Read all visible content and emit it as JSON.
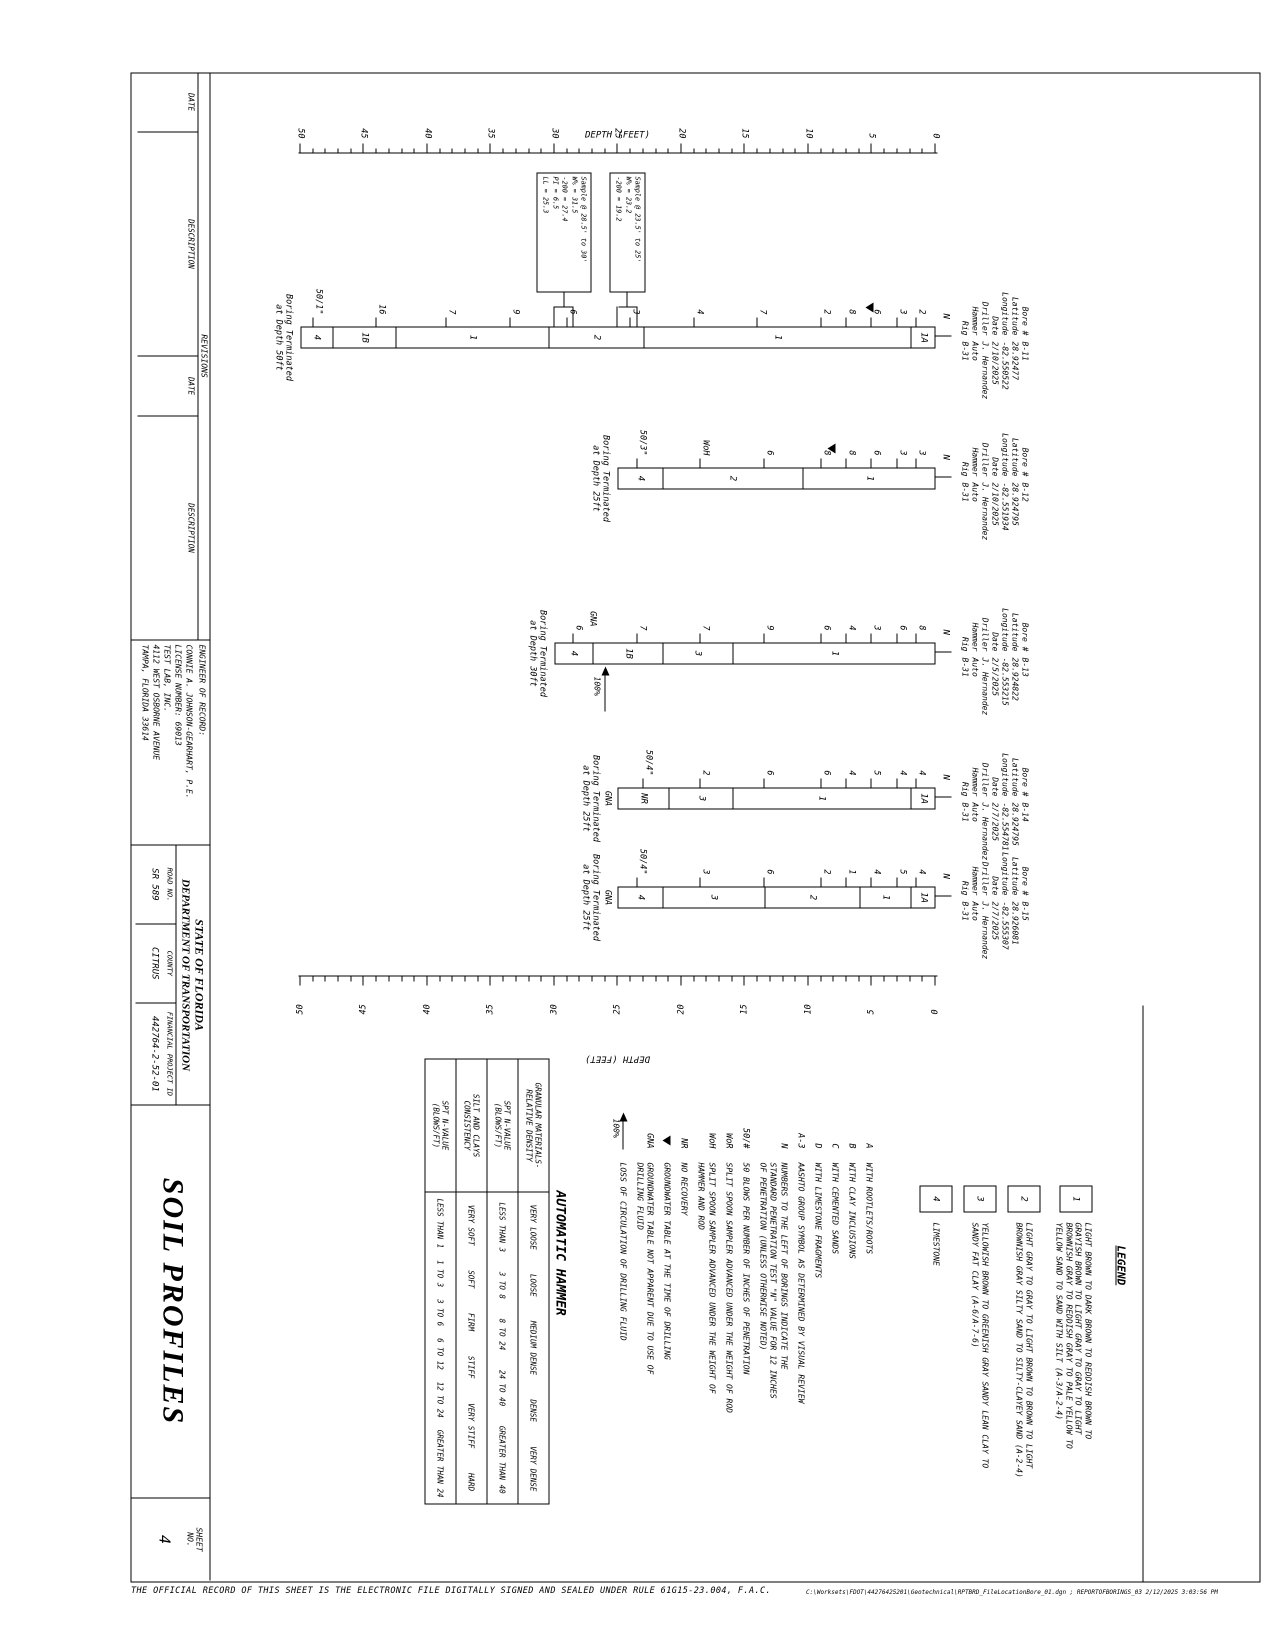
{
  "page": {
    "disclaimer": "THE OFFICIAL RECORD OF THIS SHEET IS THE ELECTRONIC FILE DIGITALLY SIGNED AND SEALED UNDER RULE 61G15-23.004, F.A.C.",
    "plot_stamp": "C:\\Worksets\\FDOT\\44276425201\\Geotechnical\\RPTBRD_FileLocationBore_01.dgn ; REPORTOFBORINGS_03    2/12/2025 3:03:56 PM"
  },
  "title_block": {
    "revisions_label": "REVISIONS",
    "rev_col_headers": [
      "DATE",
      "DESCRIPTION",
      "DATE",
      "DESCRIPTION"
    ],
    "engineer_label": "ENGINEER OF RECORD:",
    "engineer_text": "CONNIE A. JOHNSON-GEARHART, P.E.\nLICENSE NUMBER: 69013\nTEST LAB, INC.\n4112 WEST OSBORNE AVENUE\nTAMPA, FLORIDA 33614",
    "agency_line1": "STATE OF FLORIDA",
    "agency_line2": "DEPARTMENT OF TRANSPORTATION",
    "road_no_label": "ROAD NO.",
    "road_no": "SR 589",
    "county_label": "COUNTY",
    "county": "CITRUS",
    "fpid_label": "FINANCIAL PROJECT ID",
    "fpid": "442764-2-52-01",
    "sheet_title": "SOIL PROFILES",
    "sheet_no_label": "SHEET\nNO.",
    "sheet_no": "4"
  },
  "axis": {
    "caption": "DEPTH (FEET)",
    "min": 0,
    "max": 50,
    "major_step": 5
  },
  "legend": {
    "title": "LEGEND",
    "items": [
      {
        "symbol": "1",
        "text": "LIGHT BROWN TO DARK BROWN TO REDDISH BROWN TO\nGRAYISH BROWN TO LIGHT GRAY TO GRAY TO LIGHT\nBROWNISH GRAY TO REDDISH GRAY TO PALE YELLOW TO\nYELLOW SAND TO SAND WITH SILT (A-3/A-2-4)"
      },
      {
        "symbol": "2",
        "text": "LIGHT GRAY TO GRAY TO LIGHT BROWN TO BROWN TO LIGHT\nBROWNISH GRAY SILTY SAND TO SILTY-CLAYEY SAND (A-2-4)"
      },
      {
        "symbol": "3",
        "text": "YELLOWISH BROWN TO GREENISH GRAY SANDY LEAN CLAY TO\nSANDY FAT CLAY (A-6/A-7-6)"
      },
      {
        "symbol": "4",
        "text": "LIMESTONE"
      }
    ]
  },
  "notes": [
    {
      "symbol": "A",
      "type": "text",
      "text": "WITH ROOTLETS/ROOTS"
    },
    {
      "symbol": "B",
      "type": "text",
      "text": "WITH CLAY INCLUSIONS"
    },
    {
      "symbol": "C",
      "type": "text",
      "text": "WITH CEMENTED SANDS"
    },
    {
      "symbol": "D",
      "type": "text",
      "text": "WITH LIMESTONE FRAGMENTS"
    },
    {
      "symbol": "A-3",
      "type": "text",
      "text": "AASHTO GROUP SYMBOL AS DETERMINED BY VISUAL REVIEW"
    },
    {
      "symbol": "N",
      "type": "text",
      "text": "NUMBERS TO THE LEFT OF BORINGS INDICATE THE\nSTANDARD PENETRATION TEST \"N\" VALUE FOR 12 INCHES\nOF PENETRATION (UNLESS OTHERWISE NOTED)"
    },
    {
      "symbol": "50/#",
      "type": "text",
      "text": "50 BLOWS PER NUMBER OF INCHES OF PENETRATION"
    },
    {
      "symbol": "WoR",
      "type": "text",
      "text": "SPLIT SPOON SAMPLER ADVANCED UNDER THE WEIGHT OF ROD"
    },
    {
      "symbol": "WoH",
      "type": "text",
      "text": "SPLIT SPOON SAMPLER ADVANCED UNDER THE WEIGHT OF\nHAMMER AND ROD"
    },
    {
      "symbol": "NR",
      "type": "text",
      "text": "NO RECOVERY"
    },
    {
      "symbol": "gw",
      "type": "gw",
      "text": "GROUNDWATER TABLE AT THE TIME OF DRILLING"
    },
    {
      "symbol": "GNA",
      "type": "text",
      "text": "GROUNDWATER TABLE NOT APPARENT DUE TO USE OF\nDRILLING FLUID"
    },
    {
      "symbol": "100%",
      "type": "loss",
      "text": "LOSS OF CIRCULATION OF DRILLING FLUID"
    }
  ],
  "hammer_table": {
    "title": "AUTOMATIC HAMMER",
    "rows": [
      {
        "label": "GRANULAR MATERIALS-\nRELATIVE DENSITY",
        "values": [
          "VERY LOOSE",
          "LOOSE",
          "MEDIUM DENSE",
          "DENSE",
          "VERY DENSE"
        ]
      },
      {
        "label": "SPT N-VALUE\n(BLOWS/FT)",
        "values": [
          "LESS THAN 3",
          "3 TO 8",
          "8 TO 24",
          "24 TO 40",
          "GREATER THAN 40"
        ]
      },
      {
        "label": "SILT AND CLAYS\nCONSISTENCY",
        "values": [
          "VERY SOFT",
          "SOFT",
          "FIRM",
          "STIFF",
          "VERY STIFF",
          "HARD"
        ]
      },
      {
        "label": "SPT N-VALUE\n(BLOWS/FT)",
        "values": [
          "LESS THAN 1",
          "1 TO 3",
          "3 TO 6",
          "6 TO 12",
          "12 TO 24",
          "GREATER THAN 24"
        ]
      }
    ]
  },
  "borings": [
    {
      "id": "B-11",
      "x_center": 337,
      "n_column_label": "N",
      "header_labels": [
        "Bore #",
        "Latitude",
        "Longitude",
        "Date",
        "Driller",
        "Hammer",
        "Rig"
      ],
      "header_values": [
        "B-11",
        "28.92477",
        "-82.550522",
        "2/10/2025",
        "J. Hernandez",
        "Auto",
        "B-31"
      ],
      "termination_depth": 50,
      "termination_text": "Boring Terminated\nat Depth 50ft",
      "groundwater_depth": 5.5,
      "n_values": [
        {
          "depth": 1.5,
          "label": "2"
        },
        {
          "depth": 3,
          "label": "3"
        },
        {
          "depth": 5,
          "label": "6"
        },
        {
          "depth": 7,
          "label": "8"
        },
        {
          "depth": 9,
          "label": "2"
        },
        {
          "depth": 14,
          "label": "7"
        },
        {
          "depth": 19,
          "label": "4"
        },
        {
          "depth": 24,
          "label": "3"
        },
        {
          "depth": 29,
          "label": "6"
        },
        {
          "depth": 33.5,
          "label": "9"
        },
        {
          "depth": 38.5,
          "label": "7"
        },
        {
          "depth": 44,
          "label": "16"
        },
        {
          "depth": 49,
          "label": "50/1\""
        }
      ],
      "segments": [
        {
          "label": "1A",
          "from": 0,
          "to": 2
        },
        {
          "label": "1",
          "from": 2,
          "to": 23
        },
        {
          "label": "2",
          "from": 23,
          "to": 30.5
        },
        {
          "label": "1",
          "from": 30.5,
          "to": 42.5
        },
        {
          "label": "1B",
          "from": 42.5,
          "to": 47.5
        },
        {
          "label": "4",
          "from": 47.5,
          "to": 50
        }
      ],
      "samples": [
        {
          "from": 23.5,
          "to": 25,
          "text": "Sample @ 23.5' to 25'\nW% = 23.2\n-200 = 19.2"
        },
        {
          "from": 28.5,
          "to": 30,
          "text": "Sample @ 28.5' to 30'\nW% = 31.5\n-200 = 27.4\nPI = 6.5\nLL = 25.3"
        }
      ]
    },
    {
      "id": "B-12",
      "x_center": 478,
      "n_column_label": "N",
      "header_labels": [
        "Bore #",
        "Latitude",
        "Longitude",
        "Date",
        "Driller",
        "Hammer",
        "Rig"
      ],
      "header_values": [
        "B-12",
        "28.924795",
        "-82.551934",
        "2/10/2025",
        "J. Hernandez",
        "Auto",
        "B-31"
      ],
      "termination_depth": 25,
      "termination_text": "Boring Terminated\nat Depth 25ft",
      "groundwater_depth": 8.5,
      "n_values": [
        {
          "depth": 1.5,
          "label": "3"
        },
        {
          "depth": 3,
          "label": "3"
        },
        {
          "depth": 5,
          "label": "6"
        },
        {
          "depth": 7,
          "label": "8"
        },
        {
          "depth": 9,
          "label": "8"
        },
        {
          "depth": 13.5,
          "label": "6"
        },
        {
          "depth": 18.5,
          "label": "WoH"
        },
        {
          "depth": 23.5,
          "label": "50/3\""
        }
      ],
      "segments": [
        {
          "label": "1",
          "from": 0,
          "to": 10.5
        },
        {
          "label": "2",
          "from": 10.5,
          "to": 21.5
        },
        {
          "label": "4",
          "from": 21.5,
          "to": 25
        }
      ],
      "samples": []
    },
    {
      "id": "B-13",
      "x_center": 653,
      "n_column_label": "N",
      "header_labels": [
        "Bore #",
        "Latitude",
        "Longitude",
        "Date",
        "Driller",
        "Hammer",
        "Rig"
      ],
      "header_values": [
        "B-13",
        "28.924822",
        "-82.553215",
        "2/5/2025",
        "J. Hernandez",
        "Auto",
        "B-31"
      ],
      "termination_depth": 30,
      "termination_text": "Boring Terminated\nat Depth 30ft",
      "gna": {
        "label": "GNA",
        "pos": "left",
        "depth": 27
      },
      "loss": {
        "depth": 26,
        "label": "100%"
      },
      "n_values": [
        {
          "depth": 1.5,
          "label": "8"
        },
        {
          "depth": 3,
          "label": "6"
        },
        {
          "depth": 5,
          "label": "3"
        },
        {
          "depth": 7,
          "label": "4"
        },
        {
          "depth": 9,
          "label": "6"
        },
        {
          "depth": 13.5,
          "label": "9"
        },
        {
          "depth": 18.5,
          "label": "7"
        },
        {
          "depth": 23.5,
          "label": "7"
        },
        {
          "depth": 28.5,
          "label": "6"
        }
      ],
      "segments": [
        {
          "label": "1",
          "from": 0,
          "to": 16
        },
        {
          "label": "3",
          "from": 16,
          "to": 21.5
        },
        {
          "label": "1B",
          "from": 21.5,
          "to": 27
        },
        {
          "label": "4",
          "from": 27,
          "to": 30
        }
      ],
      "samples": []
    },
    {
      "id": "B-14",
      "x_center": 798,
      "n_column_label": "N",
      "header_labels": [
        "Bore #",
        "Latitude",
        "Longitude",
        "Date",
        "Driller",
        "Hammer",
        "Rig"
      ],
      "header_values": [
        "B-14",
        "28.924795",
        "-82.554781",
        "2/7/2025",
        "J. Hernandez",
        "Auto",
        "B-31"
      ],
      "termination_depth": 25,
      "termination_text": "Boring Terminated\nat Depth 25ft",
      "gna": {
        "label": "GNA",
        "pos": "below"
      },
      "n_values": [
        {
          "depth": 1.5,
          "label": "4"
        },
        {
          "depth": 3,
          "label": "4"
        },
        {
          "depth": 5,
          "label": "5"
        },
        {
          "depth": 7,
          "label": "4"
        },
        {
          "depth": 9,
          "label": "6"
        },
        {
          "depth": 13.5,
          "label": "6"
        },
        {
          "depth": 18.5,
          "label": "2"
        },
        {
          "depth": 23,
          "label": "50/4\""
        }
      ],
      "segments": [
        {
          "label": "1A",
          "from": 0,
          "to": 2
        },
        {
          "label": "1",
          "from": 2,
          "to": 16
        },
        {
          "label": "3",
          "from": 16,
          "to": 21
        },
        {
          "label": "NR",
          "from": 21,
          "to": 25
        }
      ],
      "samples": []
    },
    {
      "id": "B-15",
      "x_center": 897,
      "n_column_label": "N",
      "header_labels": [
        "Bore #",
        "Latitude",
        "Longitude",
        "Date",
        "Driller",
        "Hammer",
        "Rig"
      ],
      "header_values": [
        "B-15",
        "28.926081",
        "-82.555307",
        "2/7/2025",
        "J. Hernandez",
        "Auto",
        "B-31"
      ],
      "termination_depth": 25,
      "termination_text": "Boring Terminated\nat Depth 25ft",
      "gna": {
        "label": "GNA",
        "pos": "below"
      },
      "n_values": [
        {
          "depth": 1.5,
          "label": "4"
        },
        {
          "depth": 3,
          "label": "5"
        },
        {
          "depth": 5,
          "label": "4"
        },
        {
          "depth": 7,
          "label": "1"
        },
        {
          "depth": 9,
          "label": "2"
        },
        {
          "depth": 13.5,
          "label": "6"
        },
        {
          "depth": 18.5,
          "label": "3"
        },
        {
          "depth": 23.5,
          "label": "50/4\""
        }
      ],
      "segments": [
        {
          "label": "1A",
          "from": 0,
          "to": 2
        },
        {
          "label": "1",
          "from": 2,
          "to": 6
        },
        {
          "label": "2",
          "from": 6,
          "to": 13.5
        },
        {
          "label": "3",
          "from": 13.5,
          "to": 21.5
        },
        {
          "label": "4",
          "from": 21.5,
          "to": 25
        }
      ],
      "samples": []
    }
  ]
}
